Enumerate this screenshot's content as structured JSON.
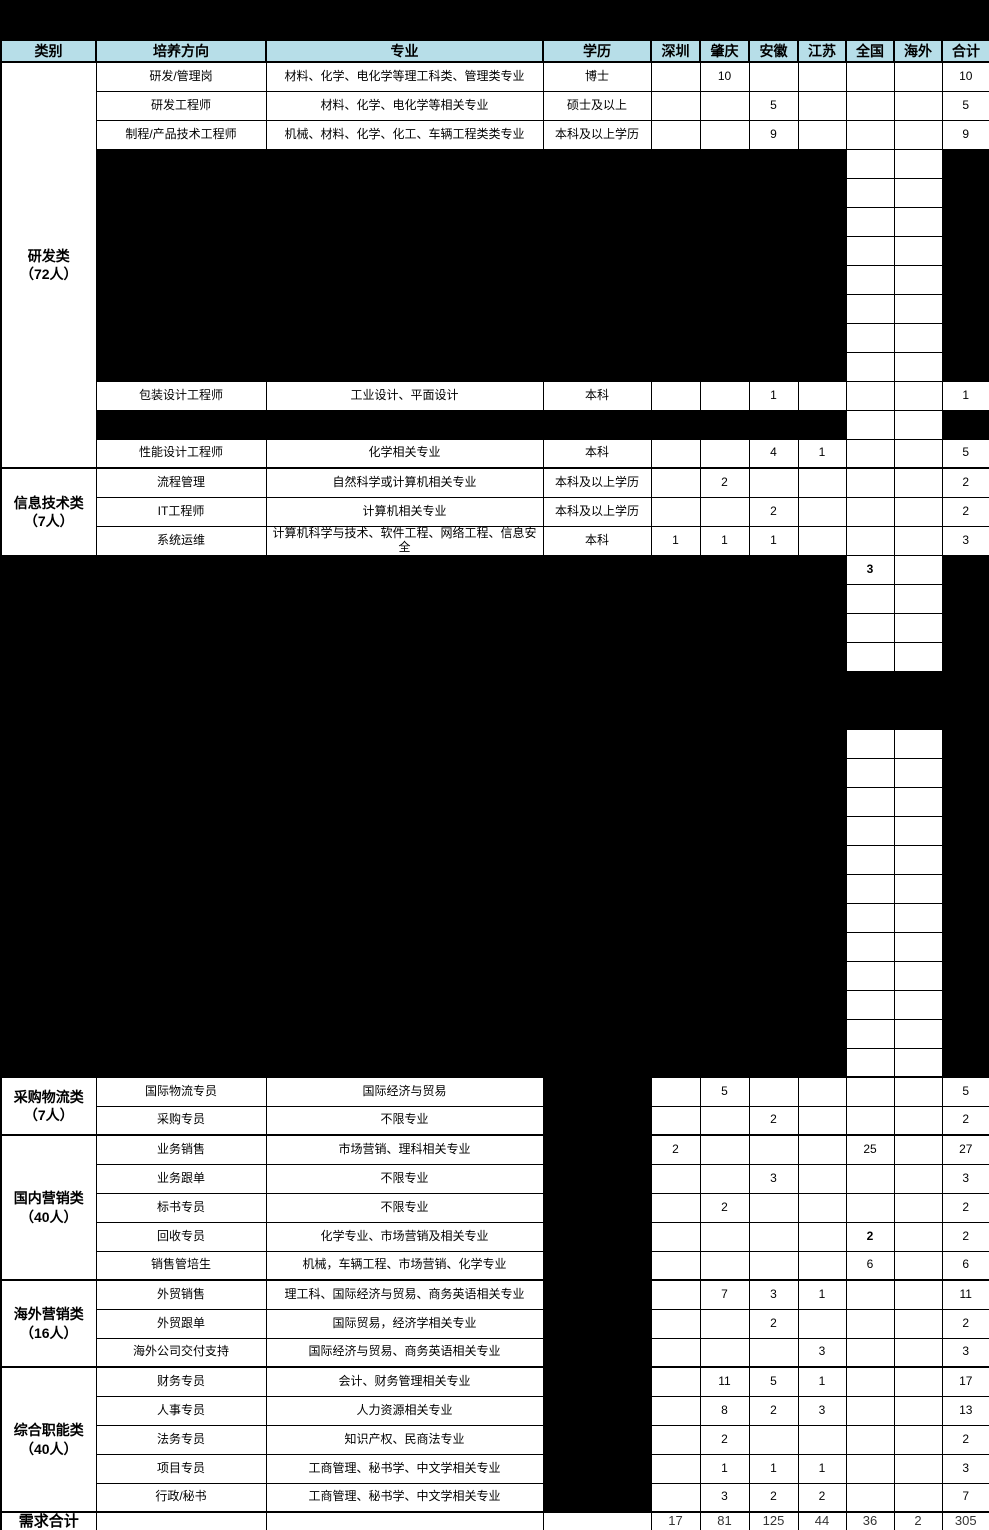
{
  "colors": {
    "header_bg": "#B7DEE8",
    "redaction": "#000000",
    "grid_line": "#000000",
    "totals_text": "#333333"
  },
  "header": {
    "columns": [
      "类别",
      "培养方向",
      "专业",
      "学历",
      "深圳",
      "肇庆",
      "安徽",
      "江苏",
      "全国",
      "海外",
      "合计"
    ]
  },
  "categories": [
    {
      "line1": "研发类",
      "line2": "（72人）"
    },
    {
      "line1": "信息技术类",
      "line2": "（7人）"
    },
    {
      "line1": "采购物流类",
      "line2": "（7人）"
    },
    {
      "line1": "国内营销类",
      "line2": "（40人）"
    },
    {
      "line1": "海外营销类",
      "line2": "（16人）"
    },
    {
      "line1": "综合职能类",
      "line2": "（40人）"
    }
  ],
  "jobs": [
    {
      "dir": "研发/管理岗",
      "major": "材料、化学、电化学等理工科类、管理类专业",
      "edu": "博士",
      "zq": "10",
      "total": "10"
    },
    {
      "dir": "研发工程师",
      "major": "材料、化学、电化学等相关专业",
      "edu": "硕士及以上",
      "ah": "5",
      "total": "5"
    },
    {
      "dir": "制程/产品技术工程师",
      "major": "机械、材料、化学、化工、车辆工程类类专业",
      "edu": "本科及以上学历",
      "ah": "9",
      "total": "9"
    },
    {
      "dir": "包装设计工程师",
      "major": "工业设计、平面设计",
      "edu": "本科",
      "ah": "1",
      "total": "1"
    },
    {
      "dir": "性能设计工程师",
      "major": "化学相关专业",
      "edu": "本科",
      "ah": "4",
      "js": "1",
      "total": "5"
    },
    {
      "dir": "流程管理",
      "major": "自然科学或计算机相关专业",
      "edu": "本科及以上学历",
      "zq": "2",
      "total": "2"
    },
    {
      "dir": "IT工程师",
      "major": "计算机相关专业",
      "edu": "本科及以上学历",
      "ah": "2",
      "total": "2"
    },
    {
      "dir": "系统运维",
      "major": "计算机科学与技术、软件工程、网络工程、信息安全",
      "edu": "本科",
      "sz": "1",
      "zq": "1",
      "ah": "1",
      "total": "3"
    },
    {
      "dir": "国际物流专员",
      "major": "国际经济与贸易",
      "zq": "5",
      "total": "5"
    },
    {
      "dir": "采购专员",
      "major": "不限专业",
      "ah": "2",
      "total": "2"
    },
    {
      "dir": "业务销售",
      "major": "市场营销、理科相关专业",
      "sz": "2",
      "qg": "25",
      "total": "27"
    },
    {
      "dir": "业务跟单",
      "major": "不限专业",
      "ah": "3",
      "total": "3"
    },
    {
      "dir": "标书专员",
      "major": "不限专业",
      "zq": "2",
      "total": "2"
    },
    {
      "dir": "回收专员",
      "major": "化学专业、市场营销及相关专业",
      "qg": "2",
      "total": "2"
    },
    {
      "dir": "销售管培生",
      "major": "机械，车辆工程、市场营销、化学专业",
      "qg": "6",
      "total": "6"
    },
    {
      "dir": "外贸销售",
      "major": "理工科、国际经济与贸易、商务英语相关专业",
      "zq": "7",
      "ah": "3",
      "js": "1",
      "total": "11"
    },
    {
      "dir": "外贸跟单",
      "major": "国际贸易，经济学相关专业",
      "ah": "2",
      "total": "2"
    },
    {
      "dir": "海外公司交付支持",
      "major": "国际经济与贸易、商务英语相关专业",
      "js": "3",
      "total": "3"
    },
    {
      "dir": "财务专员",
      "major": "会计、财务管理相关专业",
      "zq": "11",
      "ah": "5",
      "js": "1",
      "total": "17"
    },
    {
      "dir": "人事专员",
      "major": "人力资源相关专业",
      "zq": "8",
      "ah": "2",
      "js": "3",
      "total": "13"
    },
    {
      "dir": "法务专员",
      "major": "知识产权、民商法专业",
      "zq": "2",
      "total": "2"
    },
    {
      "dir": "项目专员",
      "major": "工商管理、秘书学、中文学相关专业",
      "zq": "1",
      "ah": "1",
      "js": "1",
      "total": "3"
    },
    {
      "dir": "行政/秘书",
      "major": "工商管理、秘书学、中文学相关专业",
      "zq": "3",
      "ah": "2",
      "js": "2",
      "total": "7"
    }
  ],
  "hidden_block": {
    "national_value": "3"
  },
  "grand_total": {
    "label": "需求合计",
    "sz": "17",
    "zq": "81",
    "ah": "125",
    "js": "44",
    "qg": "36",
    "hw": "2",
    "total": "305"
  }
}
